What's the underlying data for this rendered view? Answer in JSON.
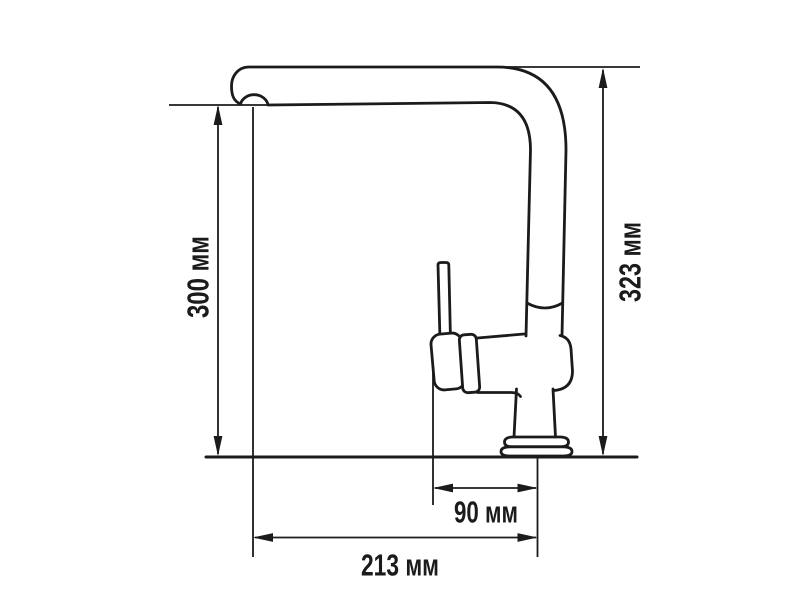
{
  "figure": {
    "name": "faucet-dimension-drawing",
    "background_color": "#ffffff",
    "line_color": "#1b1b1b",
    "dimensions": {
      "height_to_spout": {
        "label": "300 мм",
        "value": 300,
        "unit": "мм",
        "orientation": "vertical-left"
      },
      "total_height": {
        "label": "323 мм",
        "value": 323,
        "unit": "мм",
        "orientation": "vertical-right"
      },
      "spout_offset": {
        "label": "90 мм",
        "value": 90,
        "unit": "мм",
        "orientation": "horizontal"
      },
      "spout_reach": {
        "label": "213 мм",
        "value": 213,
        "unit": "мм",
        "orientation": "horizontal"
      }
    }
  }
}
